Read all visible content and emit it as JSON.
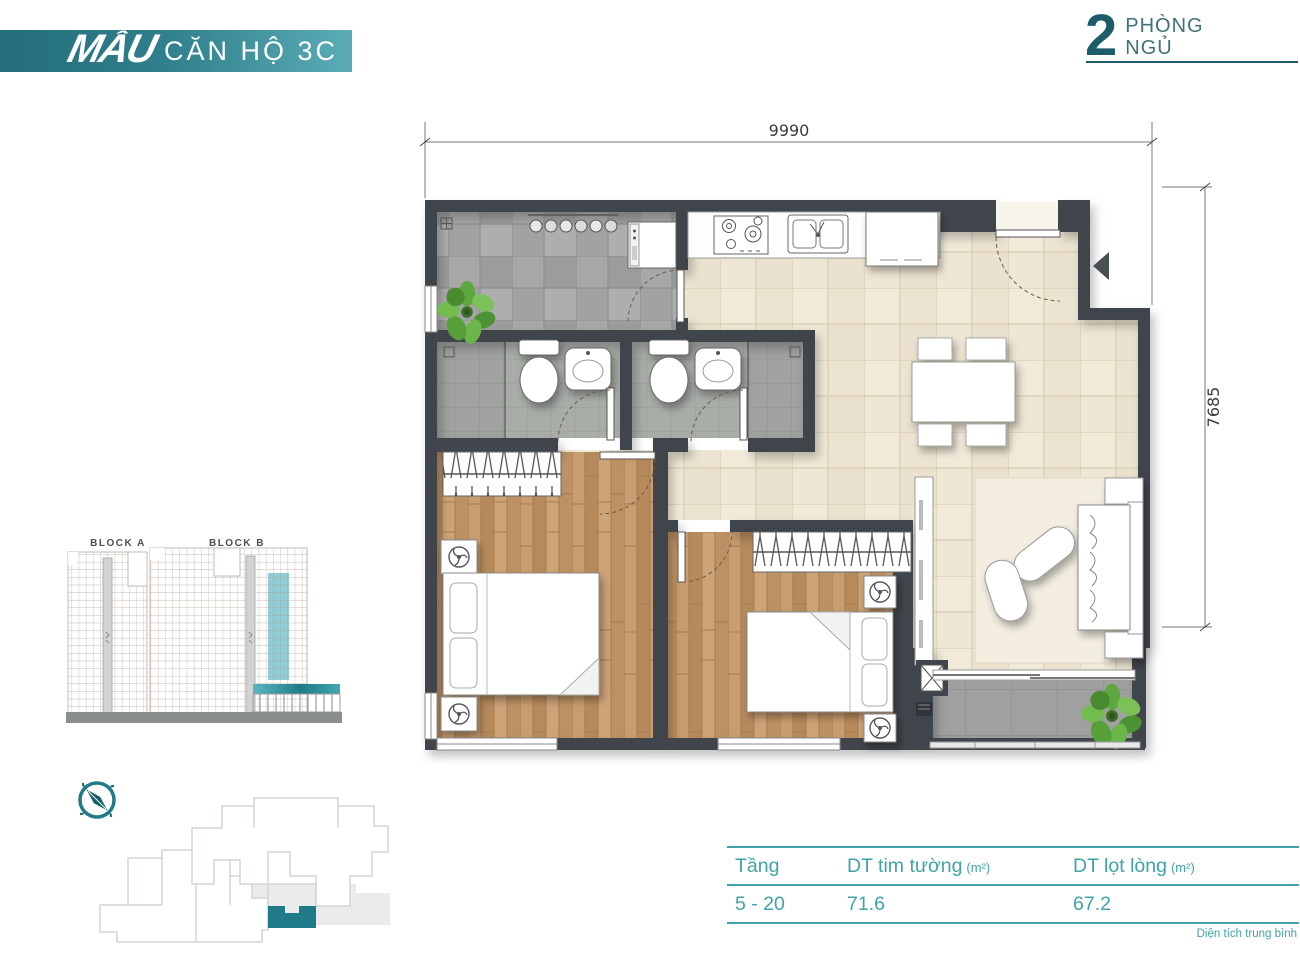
{
  "banner": {
    "logo": "MẪU",
    "title": "CĂN HỘ 3C"
  },
  "badge": {
    "number": "2",
    "label_line1": "PHÒNG",
    "label_line2": "NGỦ"
  },
  "floor_plan": {
    "dimension_top": "9990",
    "dimension_right": "7685"
  },
  "elevation": {
    "block_a_label": "BLOCK A",
    "block_b_label": "BLOCK B"
  },
  "area_table": {
    "columns": {
      "floor": "Tầng",
      "gross": "DT tim tường",
      "gross_unit": "(m²)",
      "net": "DT lọt lòng",
      "net_unit": "(m²)"
    },
    "row": {
      "floor": "5 - 20",
      "gross": "71.6",
      "net": "67.2"
    },
    "footnote": "Diện tích trung bình"
  },
  "icons": {
    "compass": "compass-icon",
    "entrance_arrow": "entrance-arrow-icon",
    "plant": "plant-icon",
    "fan": "fan-icon"
  },
  "colors": {
    "banner_teal_left": "#256e7b",
    "banner_teal_right": "#5aacb6",
    "accent_dark_teal": "#1c5d69",
    "table_teal": "#3fa3a9",
    "unit_highlight": "#85c8cf",
    "wall": "#3f454b"
  }
}
